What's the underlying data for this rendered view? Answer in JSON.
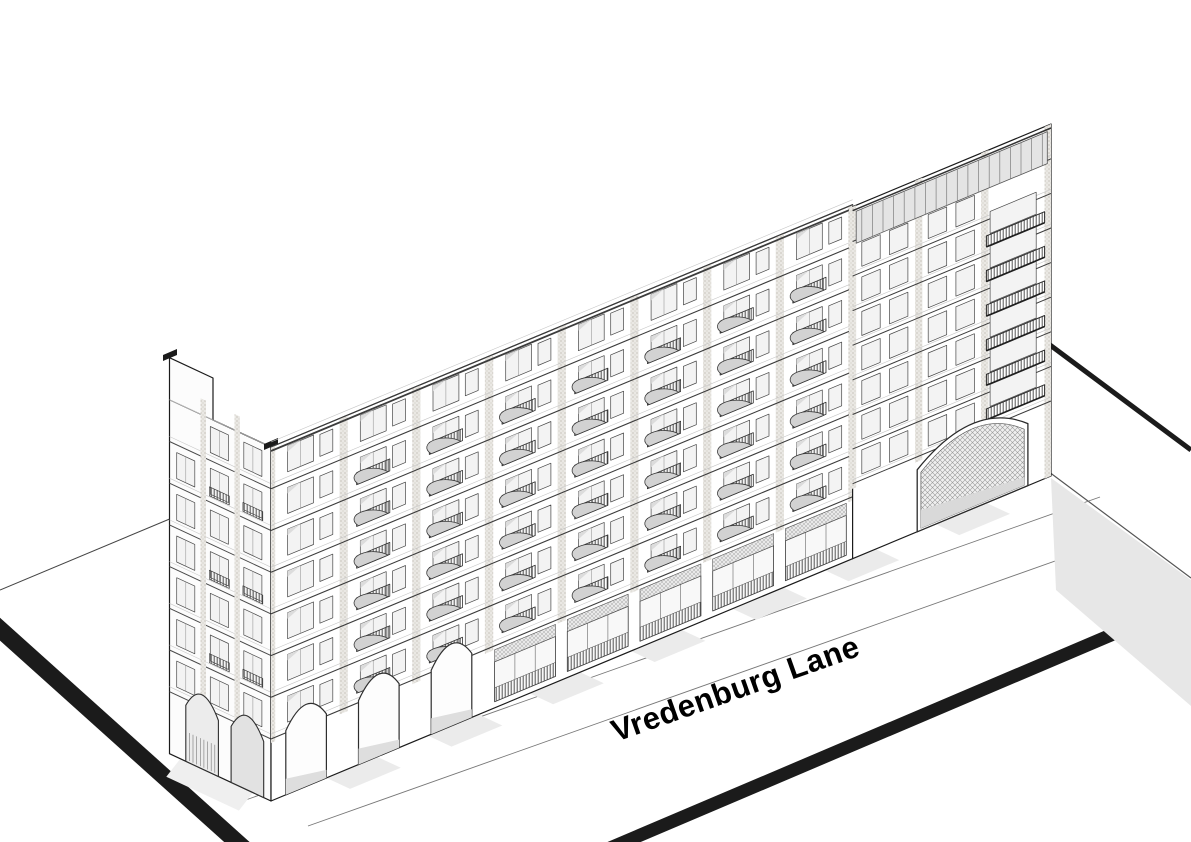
{
  "drawing": {
    "street_label": "Vredenburg Lane",
    "colors": {
      "ink": "#1b1b1b",
      "paper": "#ffffff",
      "shadow": "#e7e7e7",
      "glass": "#f3f3f3",
      "pier_base": "#eae8e4",
      "pier_dot": "#b8b3aa",
      "rail_dark": "#3f3f3f",
      "balcony_bowl": "#d2d2d2",
      "screen_bg": "#d6d6d6",
      "screen_line": "#4a4a4a",
      "unit_floor": "#a9b794",
      "unit_wall_back": "#ccd6bd",
      "unit_wall_side": "#bcc8aa",
      "unit_dot": "#8fa078",
      "unit_stair": "#b7c2a2",
      "label_color": "#0c0c0c"
    },
    "building": {
      "left_block": {
        "bays": 8,
        "upper_floors": 7,
        "ground_arches": 3,
        "ground_storefronts": 5
      },
      "right_block": {
        "bays": 3,
        "upper_floors": 8,
        "has_gateway_arch": true,
        "has_roof_terrace": true,
        "has_roof_screen": true
      },
      "end_gable": {
        "bays": 3,
        "upper_floors": 7,
        "ground_arches": 2
      },
      "cutaway_plan": {
        "highlighted_unit": true,
        "stair_count": 3,
        "has_corridor_spine": true
      }
    }
  }
}
